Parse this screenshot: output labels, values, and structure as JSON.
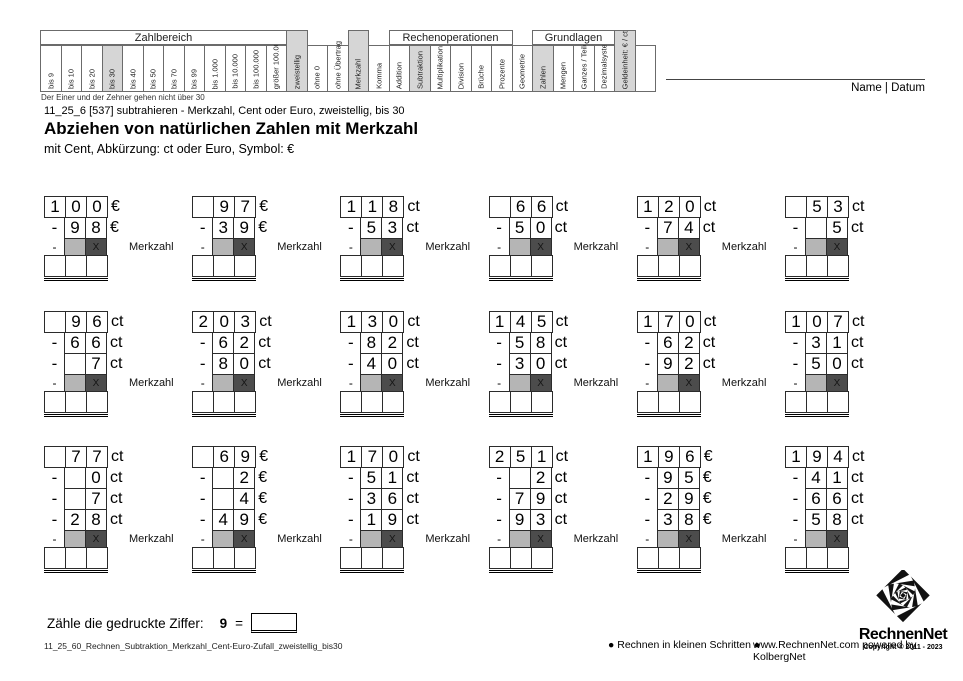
{
  "page": {
    "note_under_table": "Der Einer und der Zehner gehen nicht über 30",
    "meta": "11_25_6   [537]   subtrahieren - Merkzahl, Cent oder Euro, zweistellig, bis 30",
    "title": "Abziehen von natürlichen Zahlen mit Merkzahl",
    "subtitle": "mit Cent, Abkürzung: ct oder Euro, Symbol: €",
    "name_datum": "Name | Datum"
  },
  "topic_table": {
    "groups": [
      {
        "label": "Zahlbereich",
        "start": 0,
        "span": 12
      },
      {
        "label": "Rechenoperationen",
        "start": 17,
        "span": 6
      },
      {
        "label": "Grundlagen",
        "start": 24,
        "span": 4
      }
    ],
    "columns": [
      {
        "label": "bis 9"
      },
      {
        "label": "bis 10"
      },
      {
        "label": "bis 20"
      },
      {
        "label": "bis 30",
        "hl": true
      },
      {
        "label": "bis 40"
      },
      {
        "label": "bis 50"
      },
      {
        "label": "bis 70"
      },
      {
        "label": "bis 99"
      },
      {
        "label": "bis 1.000"
      },
      {
        "label": "bis 10.000"
      },
      {
        "label": "bis 100.000"
      },
      {
        "label": "größer 100.000"
      },
      {
        "label": "zweistellig",
        "hl": true,
        "tall": true
      },
      {
        "label": "ohne 0"
      },
      {
        "label": "ohne Übertrag"
      },
      {
        "label": "Merkzahl",
        "hl": true,
        "tall": true
      },
      {
        "label": "Komma"
      },
      {
        "label": "Addition"
      },
      {
        "label": "Subtraktion",
        "hl": true
      },
      {
        "label": "Multiplikation"
      },
      {
        "label": "Division"
      },
      {
        "label": "Brüche"
      },
      {
        "label": "Prozente"
      },
      {
        "label": "Geometrie"
      },
      {
        "label": "Zahlen",
        "hl": true
      },
      {
        "label": "Mengen"
      },
      {
        "label": "Ganzes / Teile"
      },
      {
        "label": "Dezimalsystem"
      },
      {
        "label": "Geldeinheit: € / ct",
        "hl": true,
        "tall": true
      },
      {
        "label": ""
      }
    ]
  },
  "problems": {
    "merkzahl_label": "Merkzahl",
    "merkzahl_x": "X",
    "minus_sign": "-",
    "row_tops": [
      196,
      311,
      446
    ],
    "col_step": 148.2,
    "rows": [
      [
        {
          "minuend": [
            "1",
            "0",
            "0"
          ],
          "unit": "€",
          "subtrahends": [
            [
              "9",
              "8"
            ]
          ]
        },
        {
          "minuend": [
            "",
            "9",
            "7"
          ],
          "unit": "€",
          "subtrahends": [
            [
              "3",
              "9"
            ]
          ]
        },
        {
          "minuend": [
            "1",
            "1",
            "8"
          ],
          "unit": "ct",
          "subtrahends": [
            [
              "5",
              "3"
            ]
          ]
        },
        {
          "minuend": [
            "",
            "6",
            "6"
          ],
          "unit": "ct",
          "subtrahends": [
            [
              "5",
              "0"
            ]
          ]
        },
        {
          "minuend": [
            "1",
            "2",
            "0"
          ],
          "unit": "ct",
          "subtrahends": [
            [
              "7",
              "4"
            ]
          ]
        },
        {
          "minuend": [
            "",
            "5",
            "3"
          ],
          "unit": "ct",
          "subtrahends": [
            [
              "",
              "5"
            ]
          ],
          "no_label": true
        }
      ],
      [
        {
          "minuend": [
            "",
            "9",
            "6"
          ],
          "unit": "ct",
          "subtrahends": [
            [
              "6",
              "6"
            ],
            [
              "",
              "7"
            ]
          ]
        },
        {
          "minuend": [
            "2",
            "0",
            "3"
          ],
          "unit": "ct",
          "subtrahends": [
            [
              "6",
              "2"
            ],
            [
              "8",
              "0"
            ]
          ]
        },
        {
          "minuend": [
            "1",
            "3",
            "0"
          ],
          "unit": "ct",
          "subtrahends": [
            [
              "8",
              "2"
            ],
            [
              "4",
              "0"
            ]
          ]
        },
        {
          "minuend": [
            "1",
            "4",
            "5"
          ],
          "unit": "ct",
          "subtrahends": [
            [
              "5",
              "8"
            ],
            [
              "3",
              "0"
            ]
          ]
        },
        {
          "minuend": [
            "1",
            "7",
            "0"
          ],
          "unit": "ct",
          "subtrahends": [
            [
              "6",
              "2"
            ],
            [
              "9",
              "2"
            ]
          ]
        },
        {
          "minuend": [
            "1",
            "0",
            "7"
          ],
          "unit": "ct",
          "subtrahends": [
            [
              "3",
              "1"
            ],
            [
              "5",
              "0"
            ]
          ],
          "no_label": true
        }
      ],
      [
        {
          "minuend": [
            "",
            "7",
            "7"
          ],
          "unit": "ct",
          "subtrahends": [
            [
              "",
              "0"
            ],
            [
              "",
              "7"
            ],
            [
              "2",
              "8"
            ]
          ]
        },
        {
          "minuend": [
            "",
            "6",
            "9"
          ],
          "unit": "€",
          "subtrahends": [
            [
              "",
              "2"
            ],
            [
              "",
              "4"
            ],
            [
              "4",
              "9"
            ]
          ]
        },
        {
          "minuend": [
            "1",
            "7",
            "0"
          ],
          "unit": "ct",
          "subtrahends": [
            [
              "5",
              "1"
            ],
            [
              "3",
              "6"
            ],
            [
              "1",
              "9"
            ]
          ]
        },
        {
          "minuend": [
            "2",
            "5",
            "1"
          ],
          "unit": "ct",
          "subtrahends": [
            [
              "",
              "2"
            ],
            [
              "7",
              "9"
            ],
            [
              "9",
              "3"
            ]
          ]
        },
        {
          "minuend": [
            "1",
            "9",
            "6"
          ],
          "unit": "€",
          "subtrahends": [
            [
              "9",
              "5"
            ],
            [
              "2",
              "9"
            ],
            [
              "3",
              "8"
            ]
          ]
        },
        {
          "minuend": [
            "1",
            "9",
            "4"
          ],
          "unit": "ct",
          "subtrahends": [
            [
              "4",
              "1"
            ],
            [
              "6",
              "6"
            ],
            [
              "5",
              "8"
            ]
          ],
          "no_label": true
        }
      ]
    ]
  },
  "counting_task": {
    "prompt": "Zähle die gedruckte Ziffer:",
    "digit": "9",
    "equals": "="
  },
  "footer": {
    "left": "11_25_60_Rechnen_Subtraktion_Merkzahl_Cent-Euro-Zufall_zweistellig_bis30",
    "mid": "● Rechnen in kleinen Schritten ●",
    "right": "www.RechnenNet.com powered by KolbergNet"
  },
  "logo": {
    "name": "RechnenNet",
    "copyright": "Copyright © 2011 - 2023"
  },
  "colors": {
    "highlight": "#d6d6d6",
    "merkzahl_light": "#b5b5b5",
    "merkzahl_dark": "#4c4c4c",
    "border": "#2b2b2b"
  }
}
